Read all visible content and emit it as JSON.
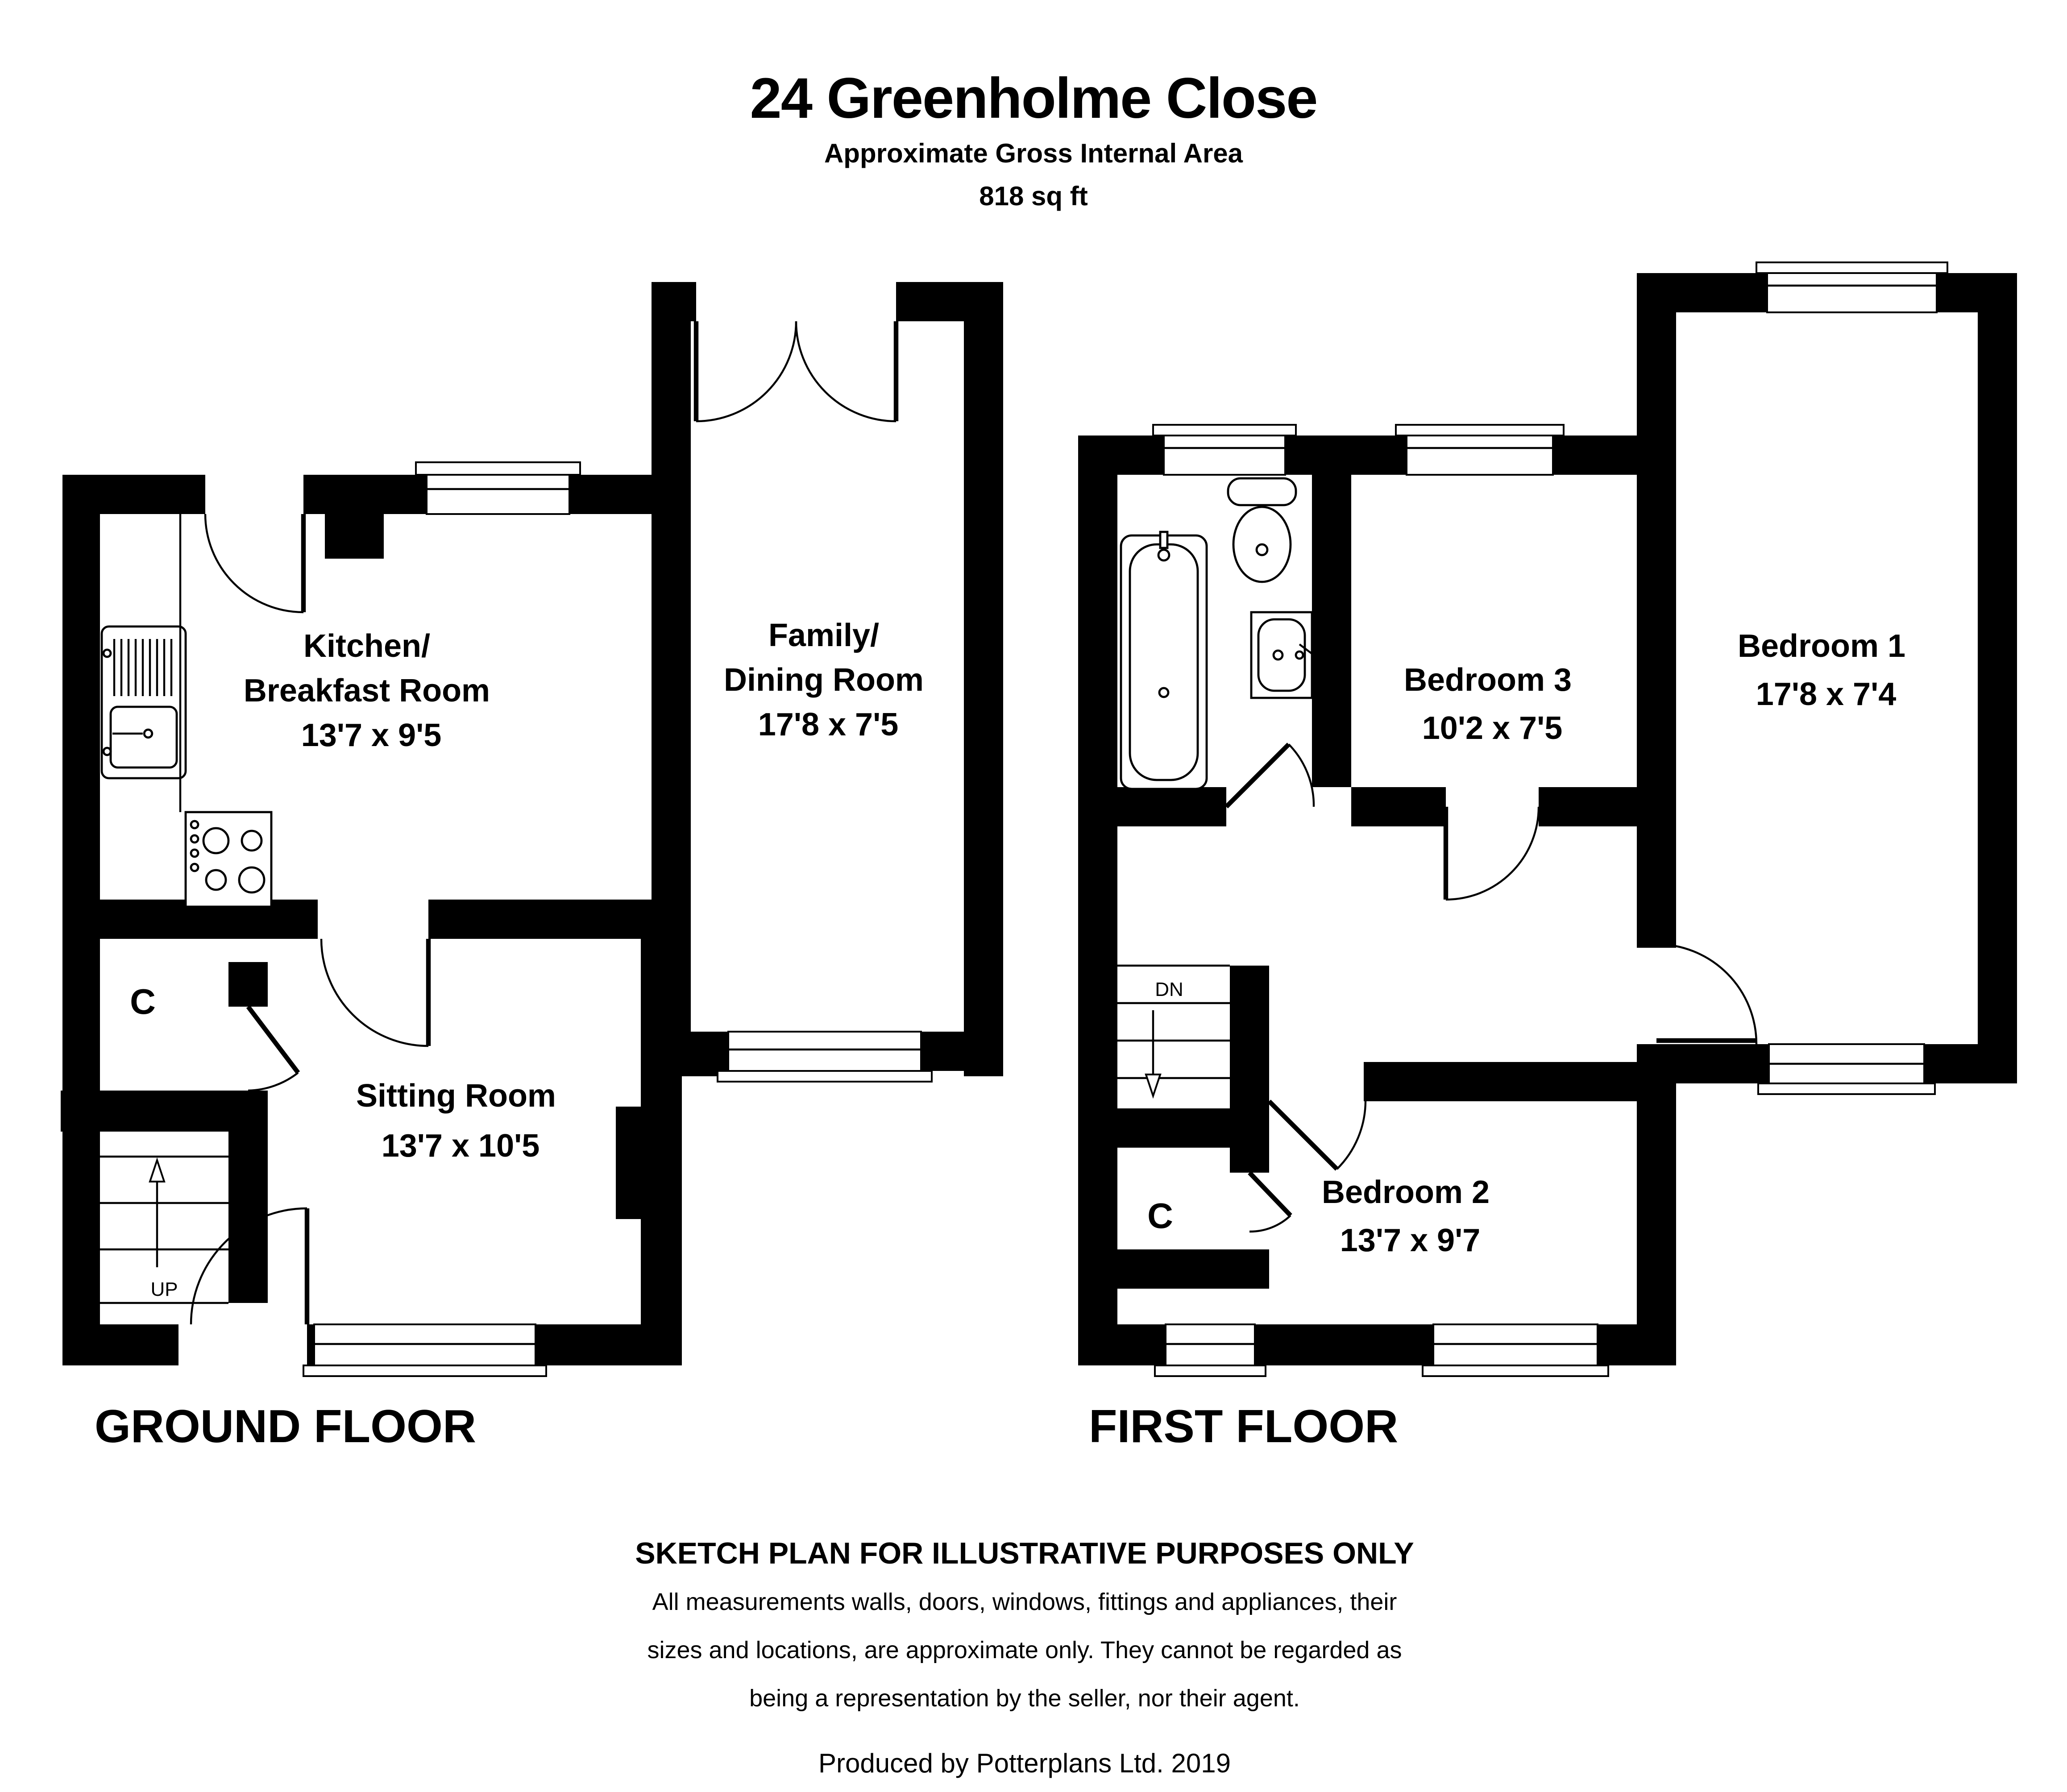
{
  "header": {
    "title": "24 Greenholme Close",
    "subtitle": "Approximate Gross Internal Area",
    "area": "818 sq ft"
  },
  "ground_floor": {
    "label": "GROUND FLOOR",
    "rooms": [
      {
        "name": "Kitchen/Breakfast Room",
        "dims": "13'7 x 9'5",
        "lines": [
          "Kitchen/",
          "Breakfast Room",
          "13'7 x 9'5"
        ]
      },
      {
        "name": "Family/Dining Room",
        "dims": "17'8 x 7'5",
        "lines": [
          "Family/",
          "Dining Room",
          "17'8 x 7'5"
        ]
      },
      {
        "name": "Sitting Room",
        "dims": "13'7 x 10'5",
        "lines": [
          "Sitting Room",
          "13'7 x 10'5"
        ]
      }
    ],
    "closet_label": "C",
    "stairs_label": "UP"
  },
  "first_floor": {
    "label": "FIRST FLOOR",
    "rooms": [
      {
        "name": "Bedroom 3",
        "dims": "10'2 x 7'5",
        "lines": [
          "Bedroom 3",
          "10'2 x 7'5"
        ]
      },
      {
        "name": "Bedroom 1",
        "dims": "17'8 x 7'4",
        "lines": [
          "Bedroom 1",
          "17'8 x 7'4"
        ]
      },
      {
        "name": "Bedroom 2",
        "dims": "13'7 x 9'7",
        "lines": [
          "Bedroom 2",
          "13'7 x 9'7"
        ]
      }
    ],
    "closet_label": "C",
    "stairs_label": "DN"
  },
  "footer": {
    "disclaimer_title": "SKETCH PLAN FOR ILLUSTRATIVE PURPOSES ONLY",
    "disclaimer_line1": "All measurements walls, doors, windows, fittings and appliances, their",
    "disclaimer_line2": "sizes and locations, are approximate only. They cannot be regarded as",
    "disclaimer_line3": "being a representation by the seller, nor their agent.",
    "credit": "Produced by Potterplans Ltd. 2019"
  },
  "colors": {
    "wall": "#000000",
    "background": "#ffffff"
  }
}
